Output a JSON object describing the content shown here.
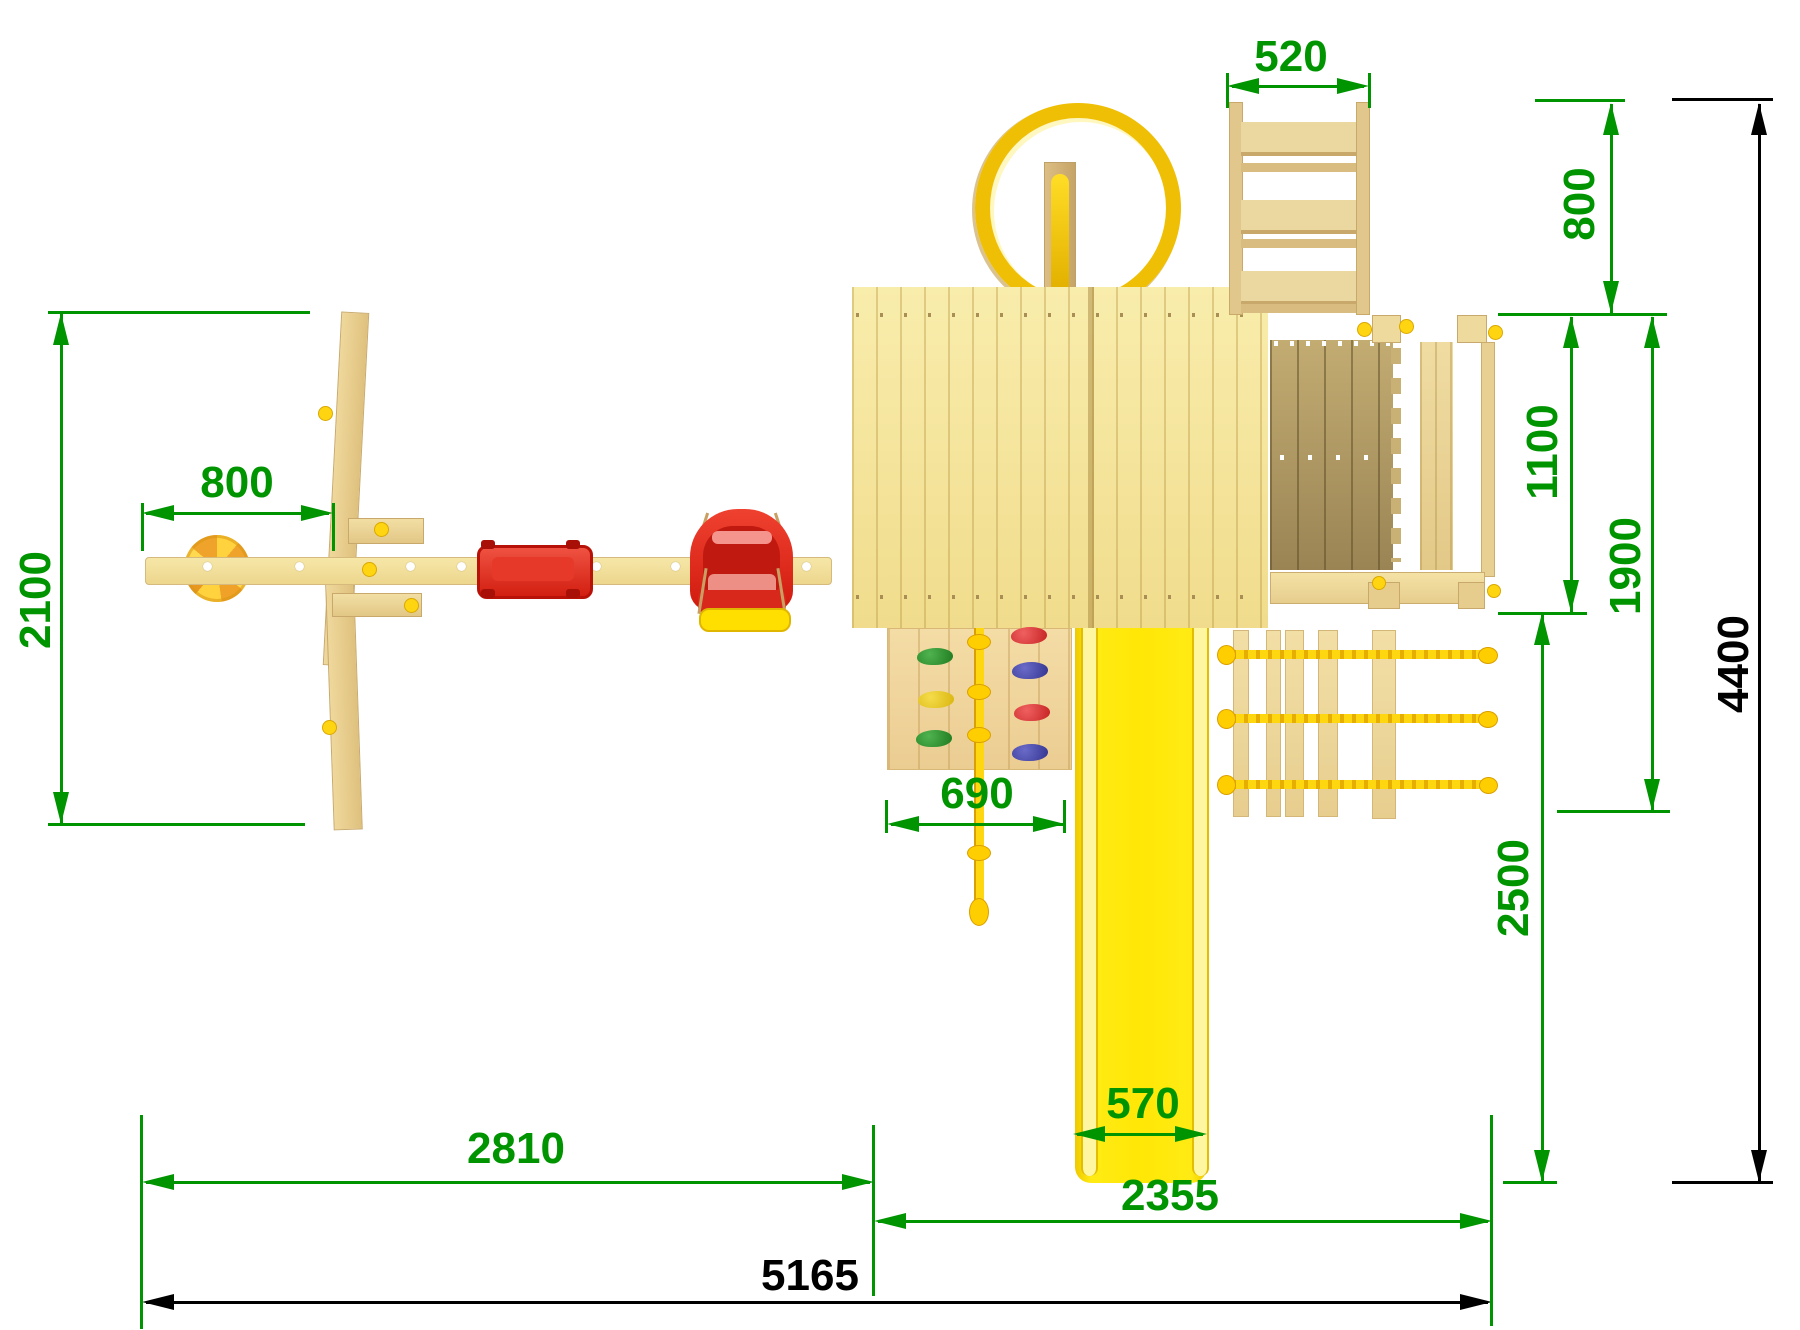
{
  "drawing": {
    "kind": "playground set top view - dimensioned technical drawing",
    "colors": {
      "dimension_green": "#009400",
      "dimension_black": "#000000",
      "wood_light": "#F4E49A",
      "wood_tan": "#E8D096",
      "wood_dark_deck": "#9C8757",
      "plastic_red": "#E5301F",
      "plastic_yellow": "#FFE806",
      "rope_yellow": "#FFD711"
    },
    "dims": {
      "d520": {
        "label": "520"
      },
      "d800r": {
        "label": "800"
      },
      "d1100": {
        "label": "1100"
      },
      "d1900": {
        "label": "1900"
      },
      "d4400": {
        "label": "4400"
      },
      "d2500": {
        "label": "2500"
      },
      "d2100": {
        "label": "2100"
      },
      "d800l": {
        "label": "800"
      },
      "d690": {
        "label": "690"
      },
      "d570": {
        "label": "570"
      },
      "d2810": {
        "label": "2810"
      },
      "d2355": {
        "label": "2355"
      },
      "d5165": {
        "label": "5165"
      }
    }
  }
}
